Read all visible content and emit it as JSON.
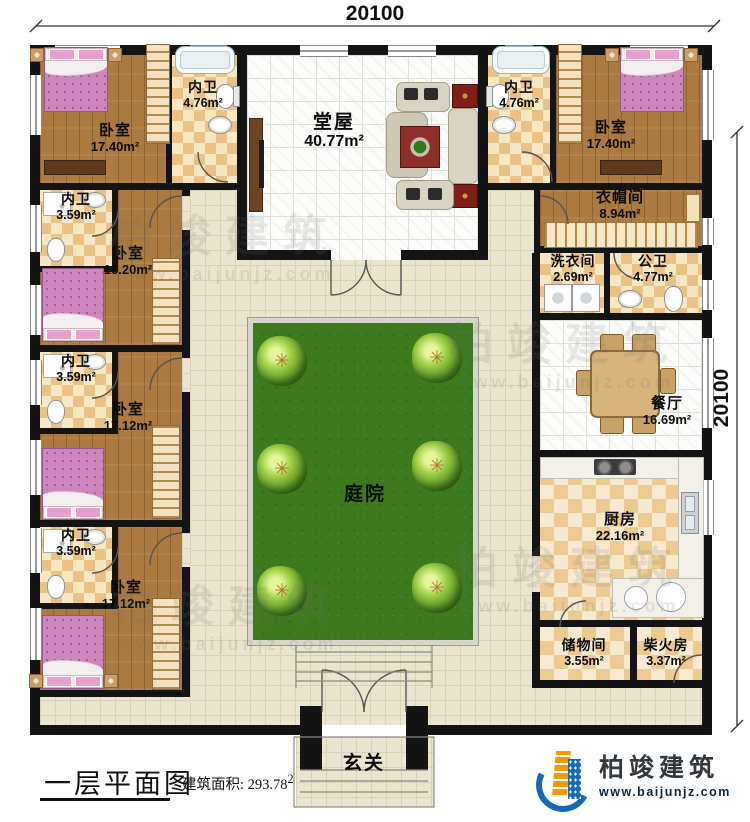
{
  "dimensions": {
    "top": "20100",
    "right": "20100"
  },
  "rooms": {
    "bedroom_tl": {
      "name": "卧室",
      "area": "17.40m²"
    },
    "bath_tl": {
      "name": "内卫",
      "area": "4.76m²"
    },
    "bath_l2": {
      "name": "内卫",
      "area": "3.59m²"
    },
    "bedroom_l2": {
      "name": "卧室",
      "area": "16.20m²"
    },
    "bath_l3": {
      "name": "内卫",
      "area": "3.59m²"
    },
    "bedroom_l3": {
      "name": "卧室",
      "area": "17.12m²"
    },
    "bath_l4": {
      "name": "内卫",
      "area": "3.59m²"
    },
    "bedroom_l4": {
      "name": "卧室",
      "area": "17.12m²"
    },
    "tangwu": {
      "name": "堂屋",
      "area": "40.77m²"
    },
    "bath_tr": {
      "name": "内卫",
      "area": "4.76m²"
    },
    "bedroom_tr": {
      "name": "卧室",
      "area": "17.40m²"
    },
    "cloakroom": {
      "name": "衣帽间",
      "area": "8.94m²"
    },
    "laundry": {
      "name": "洗衣间",
      "area": "2.69m²"
    },
    "public_bath": {
      "name": "公卫",
      "area": "4.77m²"
    },
    "dining": {
      "name": "餐厅",
      "area": "16.69m²"
    },
    "kitchen": {
      "name": "厨房",
      "area": "22.16m²"
    },
    "storage": {
      "name": "储物间",
      "area": "3.55m²"
    },
    "firewood": {
      "name": "柴火房",
      "area": "3.37m²"
    },
    "courtyard": {
      "name": "庭院"
    },
    "entrance": {
      "name": "玄关"
    }
  },
  "title": {
    "text": "一层平面图",
    "area_label": "建筑面积:",
    "area_value": "293.78",
    "area_sup": "2"
  },
  "branding": {
    "logo_text": "柏竣建筑",
    "website": "www.baijunjz.com"
  },
  "watermark": {
    "text": "柏竣建筑",
    "url": "www.baijunjz.com"
  },
  "colors": {
    "wall": "#141414",
    "wood": "#aa7a40",
    "bath_checker": "#ecc186",
    "pavement": "#eae5ce",
    "lawn_green": "#3c7a1d",
    "tile_white": "#fcfcfa",
    "bed_pink": "#cf86bd",
    "brand_blue": "#1669b2",
    "brand_orange": "#f39800"
  }
}
